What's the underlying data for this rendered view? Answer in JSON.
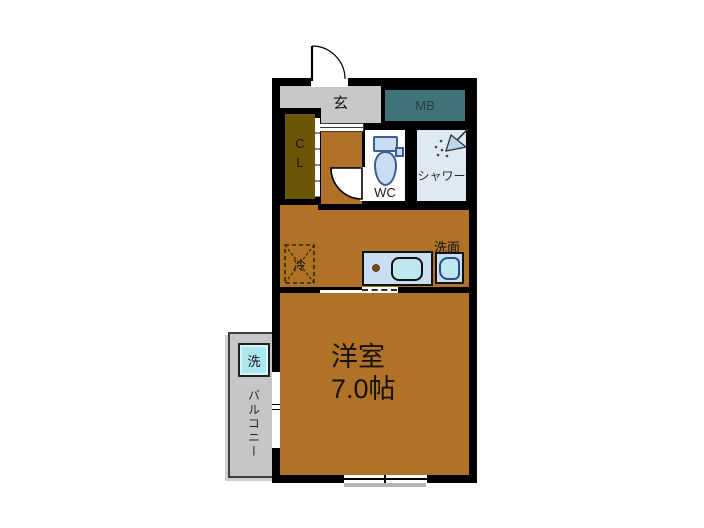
{
  "floorplan": {
    "rooms": {
      "entrance_label": "玄",
      "meter_box_label": "MB",
      "closet_label": "CL",
      "toilet_label": "WC",
      "shower_label": "シャワー",
      "refrigerator_label": "冷",
      "washbasin_label": "洗面",
      "main_room_label": "洋室",
      "main_room_size": "7.0帖",
      "washer_label": "洗",
      "balcony_label": "バルコニー"
    },
    "colors": {
      "wall": "#000000",
      "floor_brown": "#B07226",
      "closet_brown": "#6B5608",
      "meter_box_teal": "#3F7478",
      "entrance_gray": "#C8C8C8",
      "balcony_gray": "#C6C6C6",
      "fixture_blue": "#C9DEF2",
      "fixture_blue_light": "#BFE7F0",
      "shower_room_blue": "#DFE9F6",
      "washer_cyan": "#ACE7EF"
    }
  }
}
